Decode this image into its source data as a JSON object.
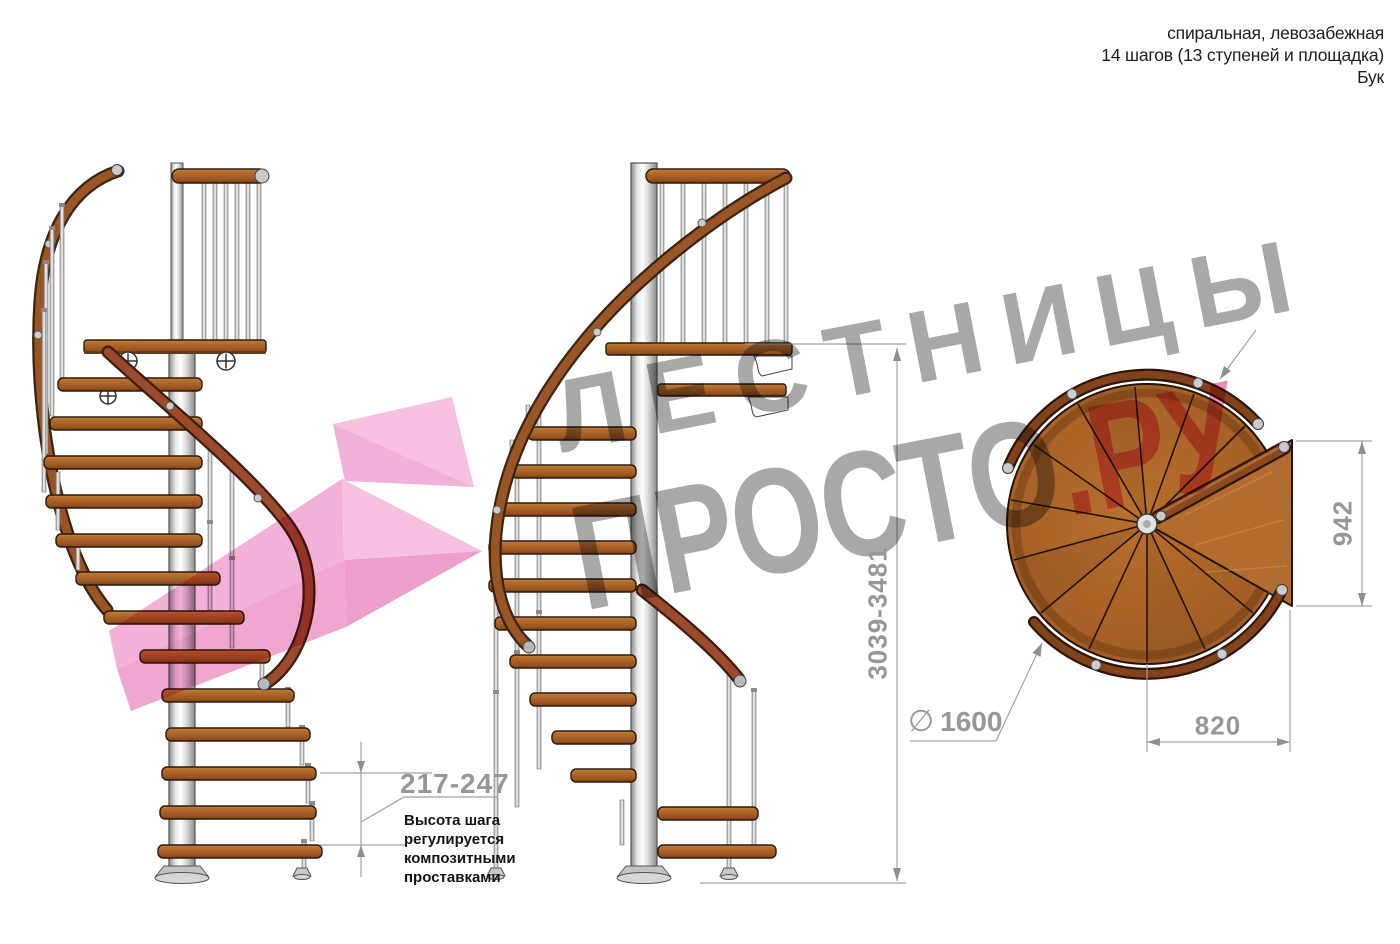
{
  "header": {
    "line1": "спиральная, левозабежная",
    "line2": "14 шагов (13 ступеней и площадка)",
    "line3": "Бук"
  },
  "watermark": {
    "line1": "ЛЕСТНИЦЫ",
    "line2_gray": "ПРОСТО",
    "line2_pink": ".РУ"
  },
  "dimensions": {
    "total_height": "3039-3481",
    "opening_depth": "942",
    "platform_width": "820",
    "diameter_symbol": "∅",
    "diameter_value": "1600",
    "step_height": "217-247",
    "step_note": "Высота шага\nрегулируется\nкомпозитными\nпроставками"
  },
  "colors": {
    "wood": "#a85f26",
    "wood_dark": "#7a3f16",
    "metal": "#d9d9d9",
    "dimension_gray": "#9b9b9b",
    "text_dark": "#1d1d1d",
    "watermark_gray": "#a8a8a8",
    "watermark_pink": "#f08cb8",
    "logo_pink": "#f2a8d4"
  }
}
